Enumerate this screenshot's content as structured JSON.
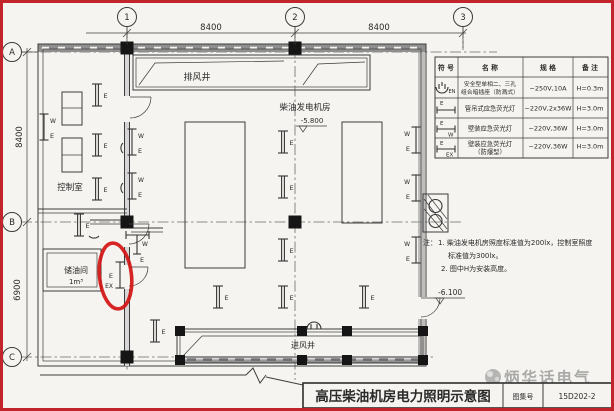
{
  "frame": {
    "border_color": "#c2242c",
    "highlight_color": "#d11212",
    "watermark_color": "#999999"
  },
  "grid": {
    "cols": [
      "1",
      "2",
      "3"
    ],
    "rows": [
      "A",
      "B",
      "C"
    ]
  },
  "dims": {
    "top_1_2": "8400",
    "top_2_3": "8400",
    "left_a_b": "8400",
    "left_b_c": "6900"
  },
  "rooms": {
    "exhaust_shaft": "排风井",
    "control_room": "控制室",
    "generator_room": "柴油发电机房",
    "generator_elev": "-5.800",
    "oil_room": "储油间",
    "oil_volume": "1m³",
    "intake_shaft": "进风井",
    "floor_elev": "-6.100"
  },
  "symbols": {
    "e": "E",
    "w": "W",
    "ex": "EX",
    "en": "EN"
  },
  "legend": {
    "headers": [
      "符 号",
      "名 称",
      "规 格",
      "备 注"
    ],
    "rows": [
      {
        "symbol": "socket-en-symbol",
        "name_lines": [
          "安全型单相二、三孔",
          "组合暗插座（防溅式）"
        ],
        "spec": "~250V,10A",
        "note": "H=0.3m"
      },
      {
        "symbol": "pendant-lamp-symbol",
        "name_lines": [
          "管吊式应急荧光灯"
        ],
        "spec": "~220V,2x36W",
        "note": "H=3.0m"
      },
      {
        "symbol": "wall-lamp-symbol",
        "name_lines": [
          "壁装应急荧光灯"
        ],
        "spec": "~220V,36W",
        "note": "H=3.0m"
      },
      {
        "symbol": "wall-lamp-ex-symbol",
        "name_lines": [
          "壁装应急荧光灯",
          "（防爆型）"
        ],
        "spec": "~220V,36W",
        "note": "H=3.0m"
      }
    ]
  },
  "notes": {
    "label": "注：",
    "lines": [
      "1. 柴油发电机房照度标准值为200lx，控制室照度",
      "标准值为300lx。",
      "2. 图中H为安装高度。"
    ]
  },
  "titleblock": {
    "title": "高压柴油机房电力照明示意图",
    "atlas_label": "图集号",
    "atlas_no": "15D202-2"
  },
  "watermark": {
    "text": "炳华话电气"
  }
}
